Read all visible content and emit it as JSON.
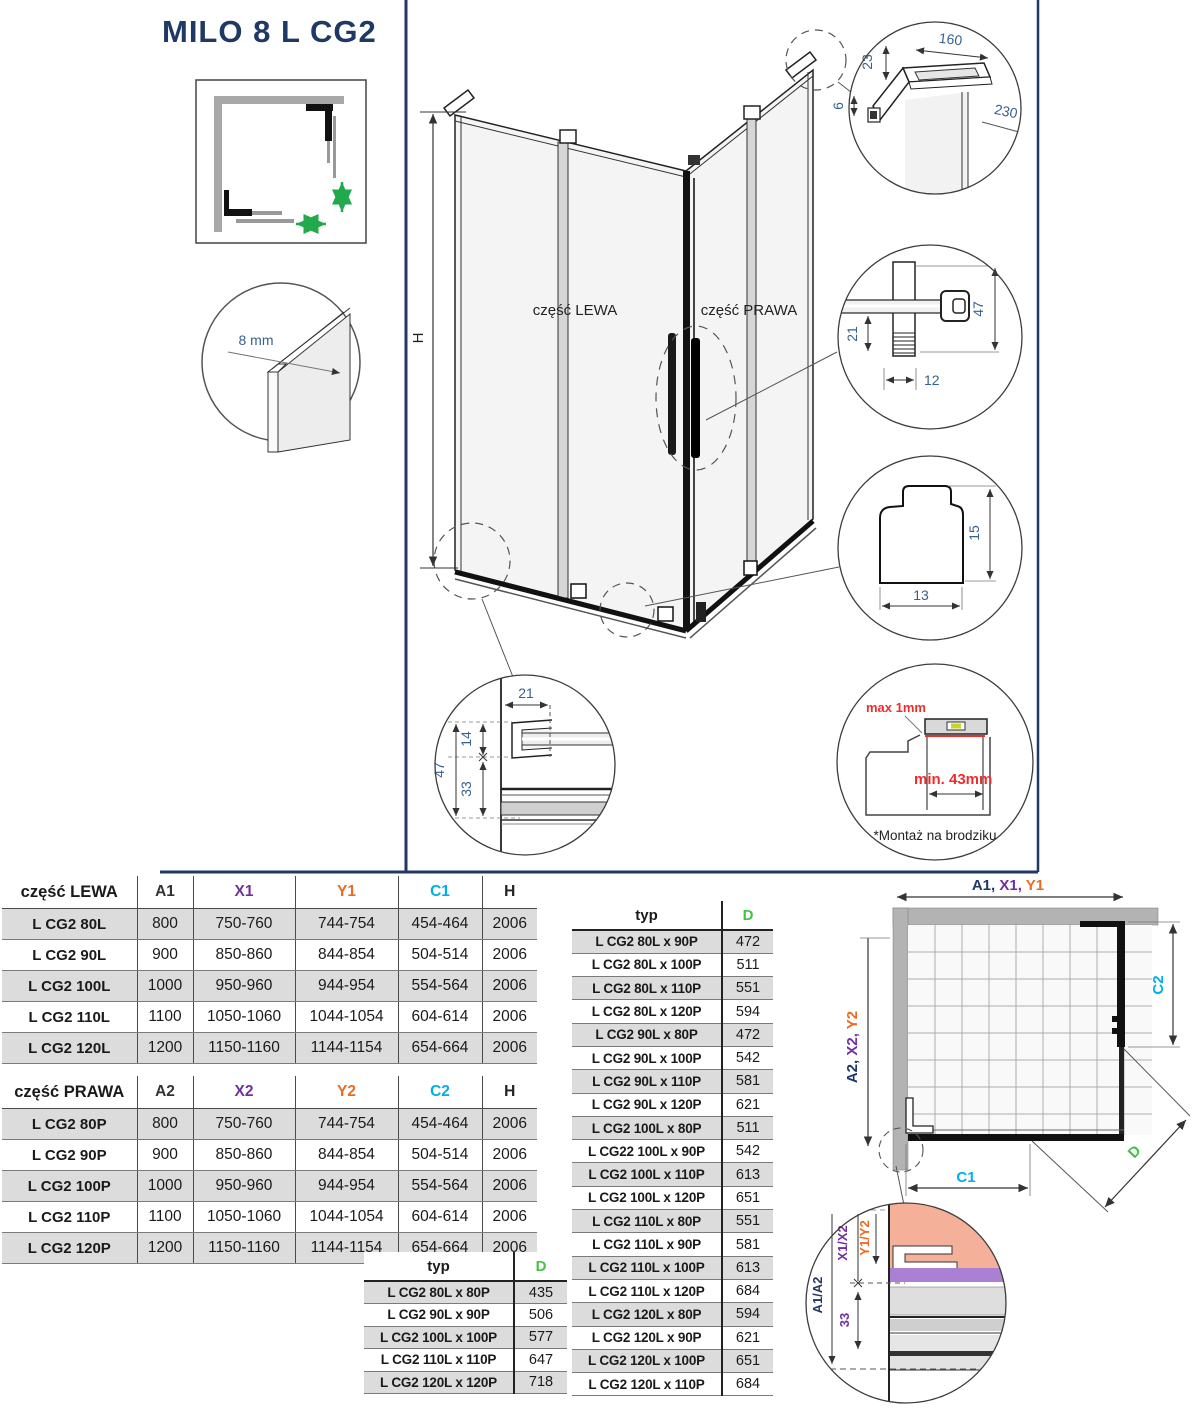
{
  "title": "MILO 8 L CG2",
  "colors": {
    "navy": "#1F3864",
    "purple": "#7030A0",
    "orange": "#ED6A21",
    "cyan": "#00AEEF",
    "green": "#44C244",
    "red": "#F02B2B",
    "dim_blue": "#36618E",
    "stripe_gray": "#DCDCDC"
  },
  "drawing": {
    "glass_thickness_label": "8 mm",
    "height_label": "H",
    "left_part_label": "część LEWA",
    "right_part_label": "część PRAWA",
    "top_bracket_detail": {
      "dim_23": "23",
      "dim_160": "160",
      "dim_6": "6",
      "dim_230": "230"
    },
    "handle_detail": {
      "dim_21": "21",
      "dim_47": "47",
      "dim_12": "12"
    },
    "profile_detail": {
      "dim_15": "15",
      "dim_13": "13"
    },
    "bottom_rail_detail": {
      "dim_21": "21",
      "dim_14": "14",
      "dim_47": "47",
      "dim_33": "33"
    },
    "tray_detail": {
      "max_label": "max 1mm",
      "min_label": "min. 43mm",
      "note": "*Montaż na brodziku"
    }
  },
  "tables": {
    "lewa": {
      "title": "część LEWA",
      "headers": [
        "A1",
        "X1",
        "Y1",
        "C1",
        "H"
      ],
      "rows": [
        [
          "L CG2 80L",
          "800",
          "750-760",
          "744-754",
          "454-464",
          "2006"
        ],
        [
          "L CG2 90L",
          "900",
          "850-860",
          "844-854",
          "504-514",
          "2006"
        ],
        [
          "L CG2 100L",
          "1000",
          "950-960",
          "944-954",
          "554-564",
          "2006"
        ],
        [
          "L CG2 110L",
          "1100",
          "1050-1060",
          "1044-1054",
          "604-614",
          "2006"
        ],
        [
          "L CG2 120L",
          "1200",
          "1150-1160",
          "1144-1154",
          "654-664",
          "2006"
        ]
      ]
    },
    "prawa": {
      "title": "część PRAWA",
      "headers": [
        "A2",
        "X2",
        "Y2",
        "C2",
        "H"
      ],
      "rows": [
        [
          "L CG2 80P",
          "800",
          "750-760",
          "744-754",
          "454-464",
          "2006"
        ],
        [
          "L CG2 90P",
          "900",
          "850-860",
          "844-854",
          "504-514",
          "2006"
        ],
        [
          "L CG2 100P",
          "1000",
          "950-960",
          "944-954",
          "554-564",
          "2006"
        ],
        [
          "L CG2 110P",
          "1100",
          "1050-1060",
          "1044-1054",
          "604-614",
          "2006"
        ],
        [
          "L CG2 120P",
          "1200",
          "1150-1160",
          "1144-1154",
          "654-664",
          "2006"
        ]
      ]
    },
    "typ_small": {
      "col_typ": "typ",
      "col_d": "D",
      "rows": [
        [
          "L CG2 80L x 80P",
          "435"
        ],
        [
          "L CG2 90L x 90P",
          "506"
        ],
        [
          "L CG2 100L x 100P",
          "577"
        ],
        [
          "L CG2 110L x 110P",
          "647"
        ],
        [
          "L CG2 120L x 120P",
          "718"
        ]
      ]
    },
    "typ_large": {
      "col_typ": "typ",
      "col_d": "D",
      "rows": [
        [
          "L CG2 80L x 90P",
          "472"
        ],
        [
          "L CG2 80L x 100P",
          "511"
        ],
        [
          "L CG2 80L x 110P",
          "551"
        ],
        [
          "L CG2 80L x 120P",
          "594"
        ],
        [
          "L CG2 90L x 80P",
          "472"
        ],
        [
          "L CG2 90L x 100P",
          "542"
        ],
        [
          "L CG2 90L x 110P",
          "581"
        ],
        [
          "L CG2 90L x 120P",
          "621"
        ],
        [
          "L CG2 100L x 80P",
          "511"
        ],
        [
          "L CG22 100L x 90P",
          "542"
        ],
        [
          "L CG2 100L x 110P",
          "613"
        ],
        [
          "L CG2 100L x 120P",
          "651"
        ],
        [
          "L CG2 110L x 80P",
          "551"
        ],
        [
          "L CG2 110L x 90P",
          "581"
        ],
        [
          "L CG2 110L x 100P",
          "613"
        ],
        [
          "L CG2 110L x 120P",
          "684"
        ],
        [
          "L CG2 120L x 80P",
          "594"
        ],
        [
          "L CG2 120L x 90P",
          "621"
        ],
        [
          "L CG2 120L x 100P",
          "651"
        ],
        [
          "L CG2 120L x 110P",
          "684"
        ]
      ]
    }
  },
  "plan": {
    "top_dim_a": "A1, ",
    "top_dim_x": "X1, ",
    "top_dim_y": "Y1",
    "left_dim_a": "A2, ",
    "left_dim_x": "X2, ",
    "left_dim_y": "Y2",
    "c1_label": "C1",
    "c2_label": "C2",
    "d_label": "D",
    "corner_detail": {
      "a_label": "A1/A2",
      "x_label": "X1/X2",
      "y_label": "Y1/Y2",
      "dim_33": "33"
    }
  }
}
